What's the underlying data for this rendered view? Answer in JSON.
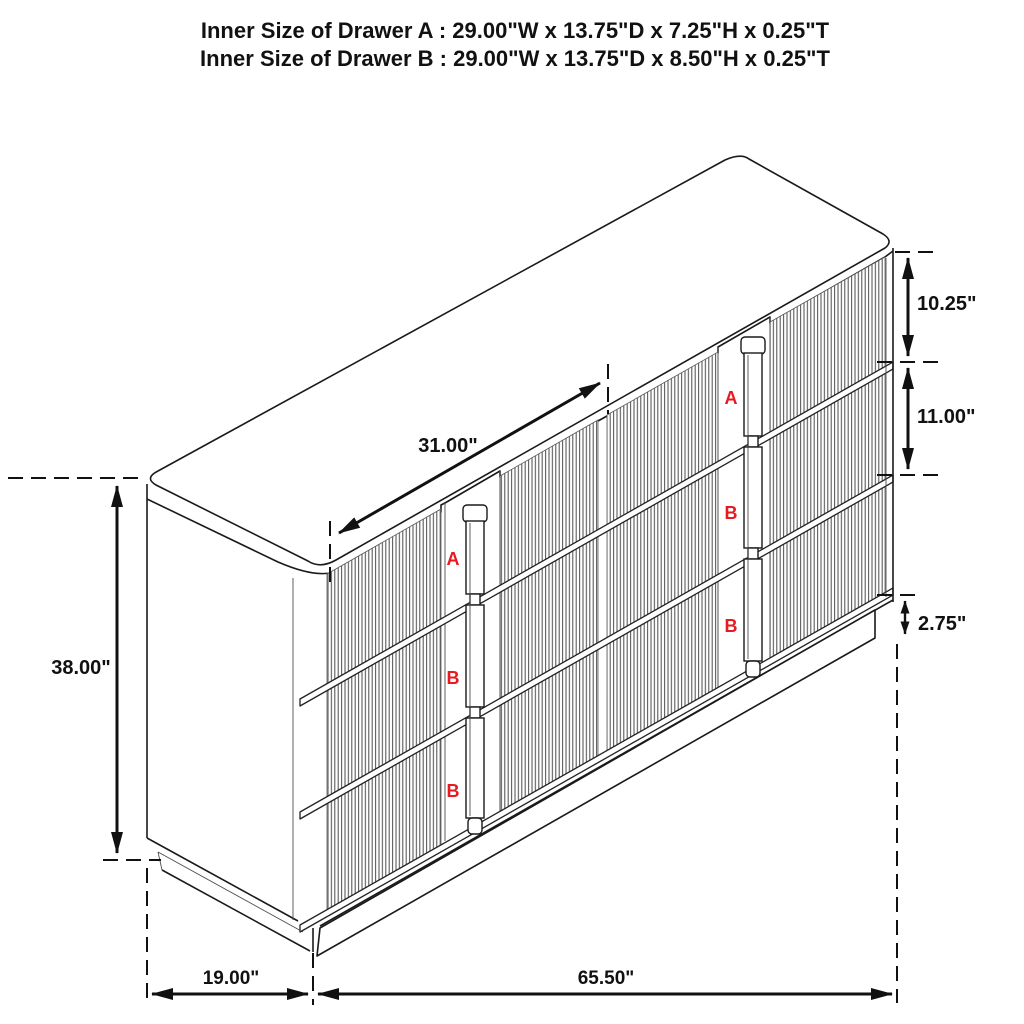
{
  "title": {
    "line1": "Inner Size of Drawer A : 29.00\"W x 13.75\"D x 7.25\"H x 0.25\"T",
    "line2": "Inner Size of Drawer B : 29.00\"W x 13.75\"D x 8.50\"H x 0.25\"T"
  },
  "dimensions": {
    "drawer_width": "31.00\"",
    "top_drawer_height": "10.25\"",
    "middle_drawer_height": "11.00\"",
    "base_height": "2.75\"",
    "overall_height": "38.00\"",
    "overall_depth": "19.00\"",
    "overall_width": "65.50\""
  },
  "drawer_markers": {
    "left": [
      "A",
      "B",
      "B"
    ],
    "right": [
      "A",
      "B",
      "B"
    ]
  },
  "colors": {
    "line": "#1a1a1a",
    "flute_line": "#4a4a4a",
    "marker_red": "#e8191f",
    "background": "#ffffff"
  }
}
